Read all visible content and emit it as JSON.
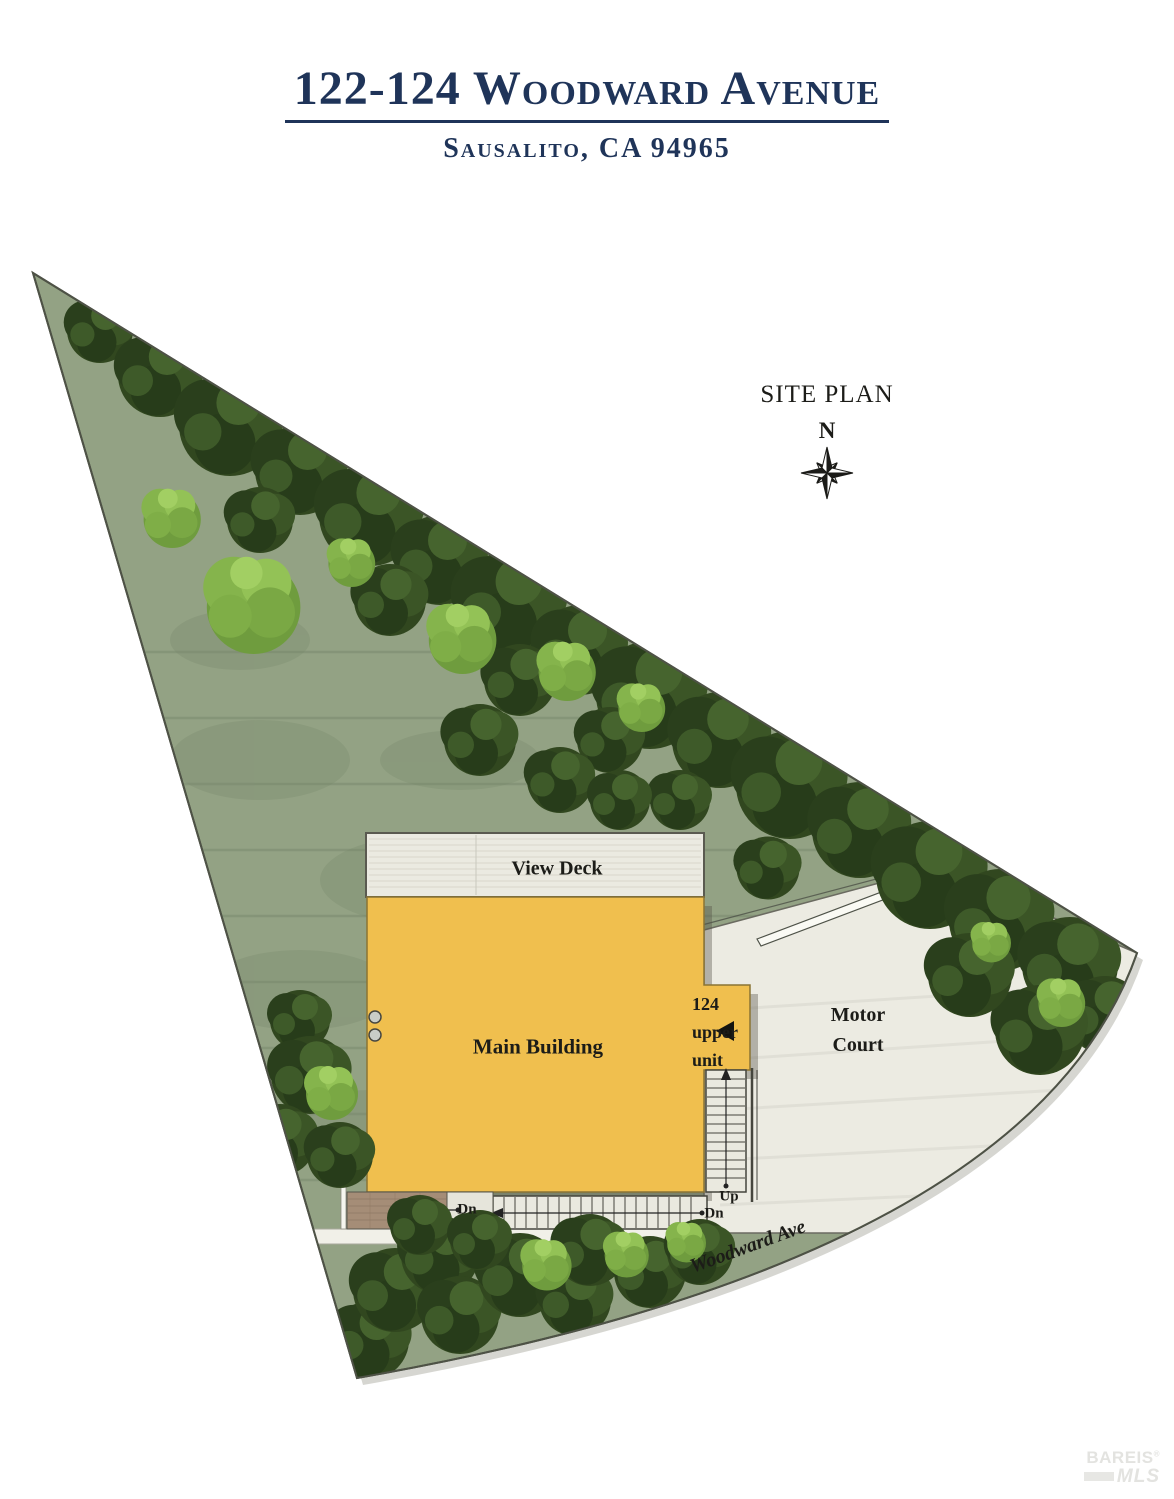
{
  "header": {
    "title": "122-124 Woodward Avenue",
    "subtitle": "Sausalito, CA 94965"
  },
  "plan": {
    "title": "SITE PLAN",
    "north_label": "N",
    "view_deck_label": "View Deck",
    "main_building_label": "Main Building",
    "upper_unit_label": "124\nupper\nunit",
    "motor_court_label": "Motor\nCourt",
    "up_label": "Up",
    "dn_left_label": "Dn",
    "dn_right_label": "Dn",
    "street_label": "Woodward Ave"
  },
  "watermark": {
    "brand": "BAREIS",
    "reg": "®",
    "mls": "MLS"
  },
  "colors": {
    "navy": "#1f3459",
    "building": "#f0bf4e",
    "deck": "#ebeae1",
    "court": "#ecebe2",
    "lawn": "#93a284",
    "tree-dark": "#31471f",
    "tree-light": "#85b44c",
    "line-dark": "#4e5246",
    "brick": "#a58d77"
  }
}
